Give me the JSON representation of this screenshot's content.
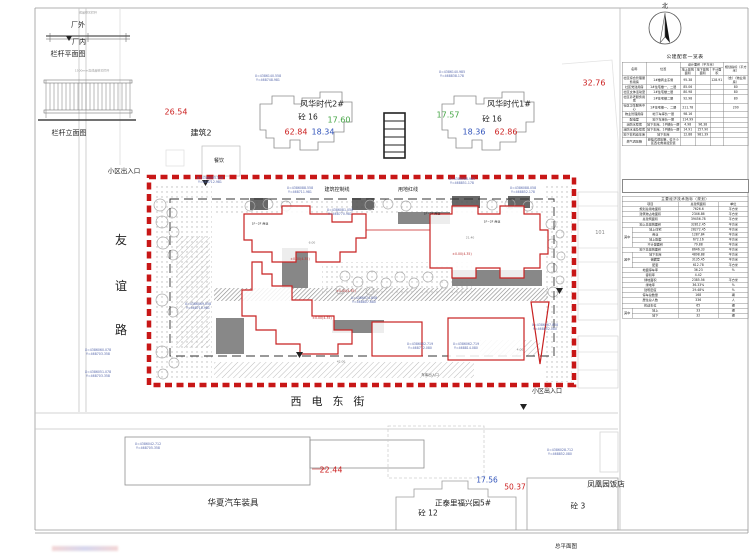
{
  "north": {
    "label": "北"
  },
  "sheet": {
    "title": "总平面图"
  },
  "streets": {
    "west": "友谊路",
    "south": "西电东街"
  },
  "plan_labels": [
    {
      "n": "factory-outside-label",
      "t": "厂外",
      "x": 78,
      "y": 25,
      "s": 7
    },
    {
      "n": "factory-inside-label",
      "t": "厂内",
      "x": 79,
      "y": 42,
      "s": 7
    },
    {
      "n": "railing-plan-title",
      "t": "栏杆平面图",
      "x": 68,
      "y": 54,
      "s": 7
    },
    {
      "n": "railing-elevation-title",
      "t": "栏杆立面图",
      "x": 69,
      "y": 133,
      "s": 7
    },
    {
      "n": "railing-note",
      "t": "成品铁艺栏杆",
      "x": 88,
      "y": 13,
      "s": 3,
      "c": "#999999"
    },
    {
      "n": "railing-note",
      "t": "1500mm高成品铁艺栏杆",
      "x": 92,
      "y": 71,
      "s": 3,
      "c": "#999999"
    },
    {
      "n": "spot-elevation",
      "t": "26.54",
      "x": 176,
      "y": 112,
      "s": 8,
      "c": "#cc2222"
    },
    {
      "n": "building2-label",
      "t": "建筑2",
      "x": 201,
      "y": 133,
      "s": 8
    },
    {
      "n": "dining-label",
      "t": "餐饮",
      "x": 219,
      "y": 161,
      "s": 5
    },
    {
      "n": "tower2-name",
      "t": "风华时代2#",
      "x": 322,
      "y": 104,
      "s": 8
    },
    {
      "n": "tower2-structure",
      "t": "砼 16",
      "x": 308,
      "y": 117,
      "s": 7.5
    },
    {
      "n": "tower1-name",
      "t": "风华时代1#",
      "x": 509,
      "y": 104,
      "s": 8
    },
    {
      "n": "tower1-structure",
      "t": "砼 16",
      "x": 492,
      "y": 119,
      "s": 7.5
    },
    {
      "n": "spot-elevation",
      "t": "62.84",
      "x": 296,
      "y": 132,
      "s": 8,
      "c": "#cc2222"
    },
    {
      "n": "spot-elevation",
      "t": "18.34",
      "x": 323,
      "y": 132,
      "s": 8,
      "c": "#3355bb"
    },
    {
      "n": "spot-elevation",
      "t": "17.60",
      "x": 339,
      "y": 120,
      "s": 8,
      "c": "#44a544"
    },
    {
      "n": "spot-elevation",
      "t": "17.57",
      "x": 448,
      "y": 115,
      "s": 8,
      "c": "#44a544"
    },
    {
      "n": "spot-elevation",
      "t": "18.36",
      "x": 474,
      "y": 132,
      "s": 8,
      "c": "#3355bb"
    },
    {
      "n": "spot-elevation",
      "t": "62.86",
      "x": 506,
      "y": 132,
      "s": 8,
      "c": "#cc2222"
    },
    {
      "n": "spot-elevation",
      "t": "32.76",
      "x": 594,
      "y": 83,
      "s": 8,
      "c": "#cc2222"
    },
    {
      "n": "entrance-label-top",
      "t": "小区出入口",
      "x": 124,
      "y": 171,
      "s": 6.5
    },
    {
      "n": "control-line-label",
      "t": "建筑控制线",
      "x": 337,
      "y": 190,
      "s": 5
    },
    {
      "n": "red-line-label",
      "t": "用地红线",
      "x": 408,
      "y": 190,
      "s": 5
    },
    {
      "n": "neighbor-101-label",
      "t": "101",
      "x": 600,
      "y": 233,
      "s": 5,
      "c": "#888888"
    },
    {
      "n": "entrance-label-bottom",
      "t": "小区出入口",
      "x": 547,
      "y": 391,
      "s": 6
    },
    {
      "n": "garage-entrance-label",
      "t": "车库出入口",
      "x": 430,
      "y": 375,
      "s": 3.5,
      "c": "#555555"
    },
    {
      "n": "spot-elevation",
      "t": "22.44",
      "x": 331,
      "y": 470,
      "s": 8,
      "c": "#cc2222"
    },
    {
      "n": "huaxia-label",
      "t": "华夏汽车装具",
      "x": 233,
      "y": 503,
      "s": 8.5
    },
    {
      "n": "spot-elevation",
      "t": "17.56",
      "x": 487,
      "y": 480,
      "s": 7.5,
      "c": "#3355bb"
    },
    {
      "n": "spot-elevation",
      "t": "50.37",
      "x": 515,
      "y": 487,
      "s": 7.5,
      "c": "#cc2222"
    },
    {
      "n": "zhengtai-label",
      "t": "正泰里福兴园5#",
      "x": 463,
      "y": 503,
      "s": 7.5
    },
    {
      "n": "tong12-label",
      "t": "砼 12",
      "x": 428,
      "y": 513,
      "s": 7.5
    },
    {
      "n": "fenghuang-label",
      "t": "凤凰园饭店",
      "x": 606,
      "y": 484,
      "s": 7.5
    },
    {
      "n": "tong3-label",
      "t": "砼 3",
      "x": 578,
      "y": 506,
      "s": 7.5
    },
    {
      "n": "level-label",
      "t": "±0.00(4.35)",
      "x": 300,
      "y": 259,
      "s": 3.2,
      "c": "#bb3333"
    },
    {
      "n": "level-label",
      "t": "±0.00(4.35)",
      "x": 346,
      "y": 291,
      "s": 3.2,
      "c": "#bb3333"
    },
    {
      "n": "level-label",
      "t": "±0.00(4.35)",
      "x": 462,
      "y": 254,
      "s": 3.2,
      "c": "#bb3333"
    },
    {
      "n": "level-label",
      "t": "±0.00(4.35)",
      "x": 322,
      "y": 318,
      "s": 3.2,
      "c": "#bb3333"
    },
    {
      "n": "use-label",
      "t": "1F~2F 商业",
      "x": 432,
      "y": 214,
      "s": 3
    },
    {
      "n": "use-label",
      "t": "1F~2F 商业",
      "x": 492,
      "y": 222,
      "s": 3
    },
    {
      "n": "use-label",
      "t": "1F~2F 商业",
      "x": 260,
      "y": 224,
      "s": 3
    },
    {
      "n": "dim-label",
      "t": "42.00",
      "x": 341,
      "y": 362,
      "s": 3,
      "c": "#777777"
    },
    {
      "n": "dim-label",
      "t": "21.40",
      "x": 470,
      "y": 238,
      "s": 3,
      "c": "#777777"
    },
    {
      "n": "dim-label",
      "t": "4.00",
      "x": 520,
      "y": 350,
      "s": 3,
      "c": "#777777"
    },
    {
      "n": "dim-label",
      "t": "6.00",
      "x": 312,
      "y": 243,
      "s": 3,
      "c": "#777777"
    }
  ],
  "coordinate_marks": [
    {
      "x": 210,
      "y": 180,
      "a": "X=4386095.558",
      "b": "Y=468712.981"
    },
    {
      "x": 300,
      "y": 190,
      "a": "X=4386088.558",
      "b": "Y=468711.981"
    },
    {
      "x": 462,
      "y": 181,
      "a": "X=4386088.985",
      "b": "Y=468851.178"
    },
    {
      "x": 523,
      "y": 190,
      "a": "X=4386088.058",
      "b": "Y=468852.178"
    },
    {
      "x": 340,
      "y": 212,
      "a": "X=4386081.058",
      "b": "Y=468770.981"
    },
    {
      "x": 364,
      "y": 300,
      "a": "X=4386074.858",
      "b": "Y=468807.680"
    },
    {
      "x": 420,
      "y": 346,
      "a": "X=4386062.719",
      "b": "Y=468772.080"
    },
    {
      "x": 466,
      "y": 346,
      "a": "X=4386062.719",
      "b": "Y=468814.080"
    },
    {
      "x": 198,
      "y": 306,
      "a": "X=4386069.558",
      "b": "Y=468710.981"
    },
    {
      "x": 545,
      "y": 327,
      "a": "X=4386067.858",
      "b": "Y=468852.080"
    },
    {
      "x": 98,
      "y": 352,
      "a": "X=4386060.078",
      "b": "Y=468703.358"
    },
    {
      "x": 98,
      "y": 374,
      "a": "X=4386051.078",
      "b": "Y=468703.358"
    },
    {
      "x": 268,
      "y": 78,
      "a": "X=4386140.558",
      "b": "Y=468748.981"
    },
    {
      "x": 452,
      "y": 74,
      "a": "X=4386140.985",
      "b": "Y=468838.178"
    },
    {
      "x": 560,
      "y": 452,
      "a": "X=4386028.712",
      "b": "Y=468852.080"
    },
    {
      "x": 148,
      "y": 446,
      "a": "X=4386042.712",
      "b": "Y=468705.358"
    }
  ],
  "amenity_table": {
    "title": "公建配套一览表",
    "headers": {
      "name": "名称",
      "location": "位置",
      "design": "设计面积（平方米）",
      "above": "地上建筑面积",
      "below": "地下建筑面积",
      "excluded": "不计面积",
      "index": "规划指标（平方米）"
    },
    "rows": [
      [
        "社区综合管理服务用房",
        "1#楼商业东侧",
        "95.38",
        "",
        "128.91",
        "（含）（物业用房）"
      ],
      [
        "社区党建用房",
        "1#住宅楼一、二层",
        "85.06",
        "",
        "",
        "80"
      ],
      [
        "社区文体活动室",
        "1#住宅楼二层",
        "80.98",
        "",
        "",
        "80"
      ],
      [
        "社区养老服务用房",
        "1#住宅楼二层",
        "92.98",
        "",
        "",
        "80"
      ],
      [
        "社区卫生服务中心",
        "1#住宅楼一、二层",
        "211.78",
        "",
        "",
        "200"
      ],
      [
        "物业管理用房",
        "地下车库负一层",
        "98.16",
        "",
        "",
        ""
      ],
      [
        "配电室",
        "地下车库负一层",
        "114.99",
        "",
        "",
        ""
      ],
      [
        "消防水泵房",
        "地下车库、1#楼负一层",
        "4.98",
        "96.38",
        "",
        ""
      ],
      [
        "消防水池及泵房",
        "地下车库、1#楼负一层",
        "14.91",
        "157.90",
        "",
        ""
      ],
      [
        "地下非机动车库",
        "地下车库",
        "12.88",
        "981.39",
        "",
        ""
      ],
      [
        "燃气调压箱",
        "悬挂式调压箱，位于小区西北角悬挂安装",
        "",
        "",
        "",
        ""
      ]
    ]
  },
  "indicator_table": {
    "title": "主要经济技术指标（规划）",
    "headers": [
      "项目",
      "总建筑面积",
      "单位"
    ],
    "rows": [
      {
        "l": "规划总用地面积",
        "v": "7626.6",
        "u": "平方米"
      },
      {
        "l": "建筑物占地面积",
        "v": "2346.86",
        "u": "平方米"
      },
      {
        "l": "总建筑面积",
        "v": "39456.78",
        "u": "平方米"
      },
      {
        "l": "地上总建筑面积",
        "v": "32812.45",
        "u": "平方米"
      },
      {
        "g": "其中",
        "gn": 4,
        "l": "地上住宅",
        "v": "28272.45",
        "u": "平方米"
      },
      {
        "i": 1,
        "l": "商业",
        "v": "1287.84",
        "u": "平方米"
      },
      {
        "i": 1,
        "l": "地上配套",
        "v": "672.16",
        "u": "平方米"
      },
      {
        "i": 1,
        "l": "不计容面积",
        "v": "79.88",
        "u": "平方米"
      },
      {
        "l": "地下总建筑面积",
        "v": "8646.33",
        "u": "平方米"
      },
      {
        "g": "其中",
        "gn": 3,
        "l": "地下车库",
        "v": "4898.88",
        "u": "平方米"
      },
      {
        "i": 1,
        "l": "储藏室",
        "v": "3135.45",
        "u": "平方米"
      },
      {
        "i": 1,
        "l": "配套",
        "v": "612.78",
        "u": "平方米"
      },
      {
        "l": "地面停车率",
        "v": "36.23",
        "u": "%"
      },
      {
        "l": "容积率",
        "v": "4.42",
        "u": ""
      },
      {
        "l": "绿地面积",
        "v": "2385.56",
        "u": "平方米"
      },
      {
        "l": "绿地率",
        "v": "36.33%",
        "u": "%"
      },
      {
        "l": "建筑密度",
        "v": "29.48%",
        "u": "%"
      },
      {
        "l": "停车总数量",
        "v": "168",
        "u": "辆"
      },
      {
        "l": "居住总人数",
        "v": "336",
        "u": "人"
      },
      {
        "l": "机动车位",
        "v": "65",
        "u": "辆"
      },
      {
        "g": "其中",
        "gn": 2,
        "l": "地上",
        "v": "33",
        "u": "辆"
      },
      {
        "i": 1,
        "l": "地下",
        "v": "32",
        "u": "辆"
      }
    ]
  }
}
